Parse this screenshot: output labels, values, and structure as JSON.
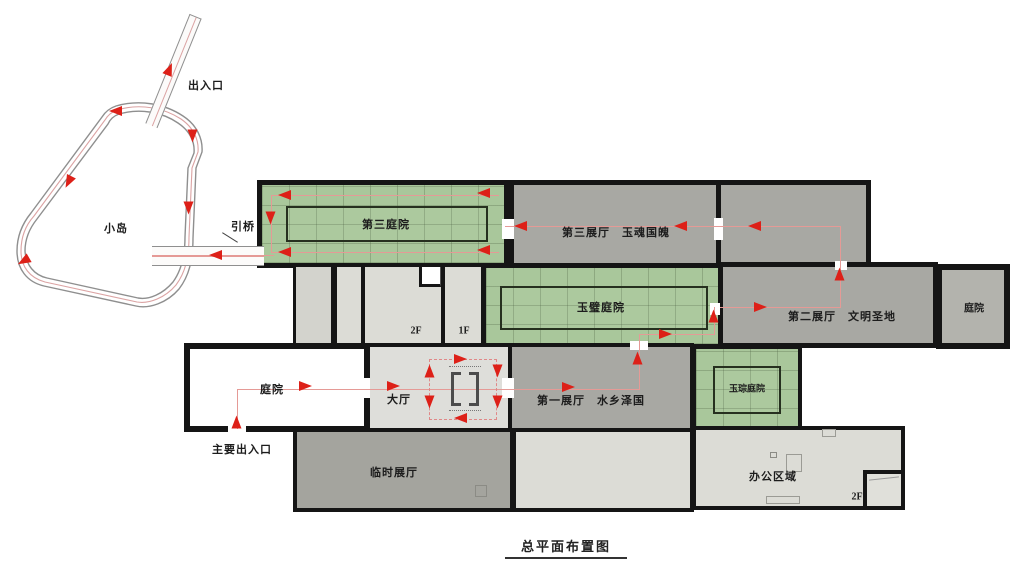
{
  "drawing_title": "总平面布置图",
  "site": {
    "island_label": "小岛",
    "entrance_label": "出入口",
    "bridge_label": "引桥",
    "main_entrance_label": "主要出入口"
  },
  "rooms": {
    "third_courtyard": "第三庭院",
    "third_hall": "第三展厅　玉魂国魄",
    "jade_bi_courtyard": "玉璧庭院",
    "second_hall": "第二展厅　文明圣地",
    "east_courtyard": "庭院",
    "west_courtyard": "庭院",
    "lobby": "大厅",
    "first_hall": "第一展厅　水乡泽国",
    "jade_cong_courtyard": "玉琮庭院",
    "temporary_hall": "临时展厅",
    "office_area": "办公区域"
  },
  "floor_labels": {
    "mid_2f": "2F",
    "mid_1f": "1F",
    "office_2f": "2F"
  },
  "icons": {
    "flow_arrow_icon": "red-triangle"
  },
  "colors": {
    "courtyard_green": "#a9c79b",
    "hall_gray": "#a8a8a3",
    "light_room_gray": "#dcdcd6",
    "wall_black": "#151515",
    "arrow_red": "#dd2018",
    "route_pink": "#e59a96"
  }
}
